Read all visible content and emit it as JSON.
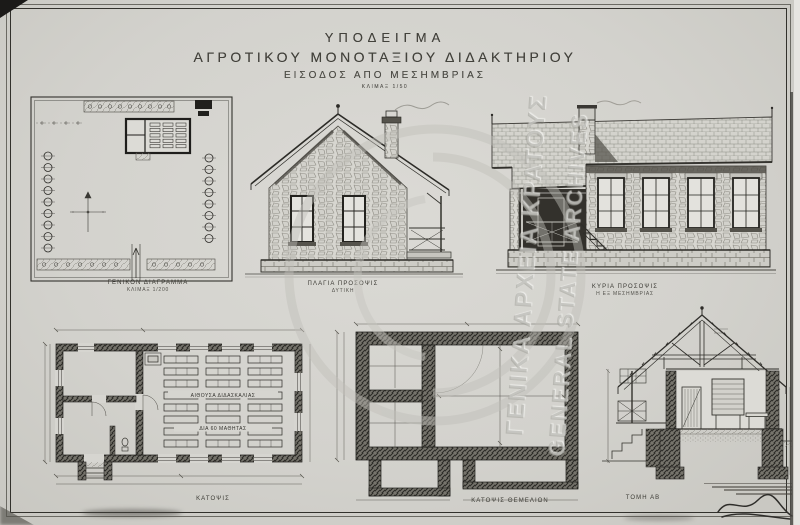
{
  "sheet": {
    "title_line1": "ΥΠΟΔΕΙΓΜΑ",
    "title_line2": "ΑΓΡΟΤΙΚΟΥ ΜΟΝΟΤΑΞΙΟΥ ΔΙΔΑΚΤΗΡΙΟΥ",
    "subtitle": "ΕΙΣΟΔΟΣ ΑΠΟ ΜΕΣΗΜΒΡΙΑΣ",
    "scale_note": "ΚΛΙΜΑΞ 1/50"
  },
  "drawings": {
    "site_plan": {
      "caption1": "ΓΕΝΙΚΟΝ ΔΙΑΓΡΑΜΜΑ",
      "caption2": "ΚΛΙΜΑΞ 1/200"
    },
    "side_elevation": {
      "caption1": "ΠΛΑΓΙΑ ΠΡΟΣΟΨΙΣ",
      "caption2": "ΔΥΤΙΚΗ"
    },
    "main_elevation": {
      "caption1": "ΚΥΡΙΑ ΠΡΟΣΟΨΙΣ",
      "caption2": "Η ΕΞ ΜΕΣΗΜΒΡΙΑΣ"
    },
    "floor_plan": {
      "caption1": "ΚΑΤΟΨΙΣ",
      "room_label1": "ΑΙΘΟΥΣΑ ΔΙΔΑΣΚΑΛΙΑΣ",
      "room_label2": "ΔΙΑ 60 ΜΑΘΗΤΑΣ"
    },
    "foundation_plan": {
      "caption1": "ΚΑΤΟΨΙΣ ΘΕΜΕΛΙΩΝ"
    },
    "section": {
      "caption1": "ΤΟΜΗ ΑΒ"
    }
  },
  "watermark": {
    "line_greek": "ΓΕΝΙΚΑ ΑΡΧΕΙΑ ΚΡΑΤΟΥΣ",
    "line_english": "GENERAL STATE ARCHIVES"
  },
  "colors": {
    "paper": "#d6d5d0",
    "ink": "#2f2e2a",
    "wall_cut": "#77756d",
    "watermark": "#bdbcb6"
  }
}
